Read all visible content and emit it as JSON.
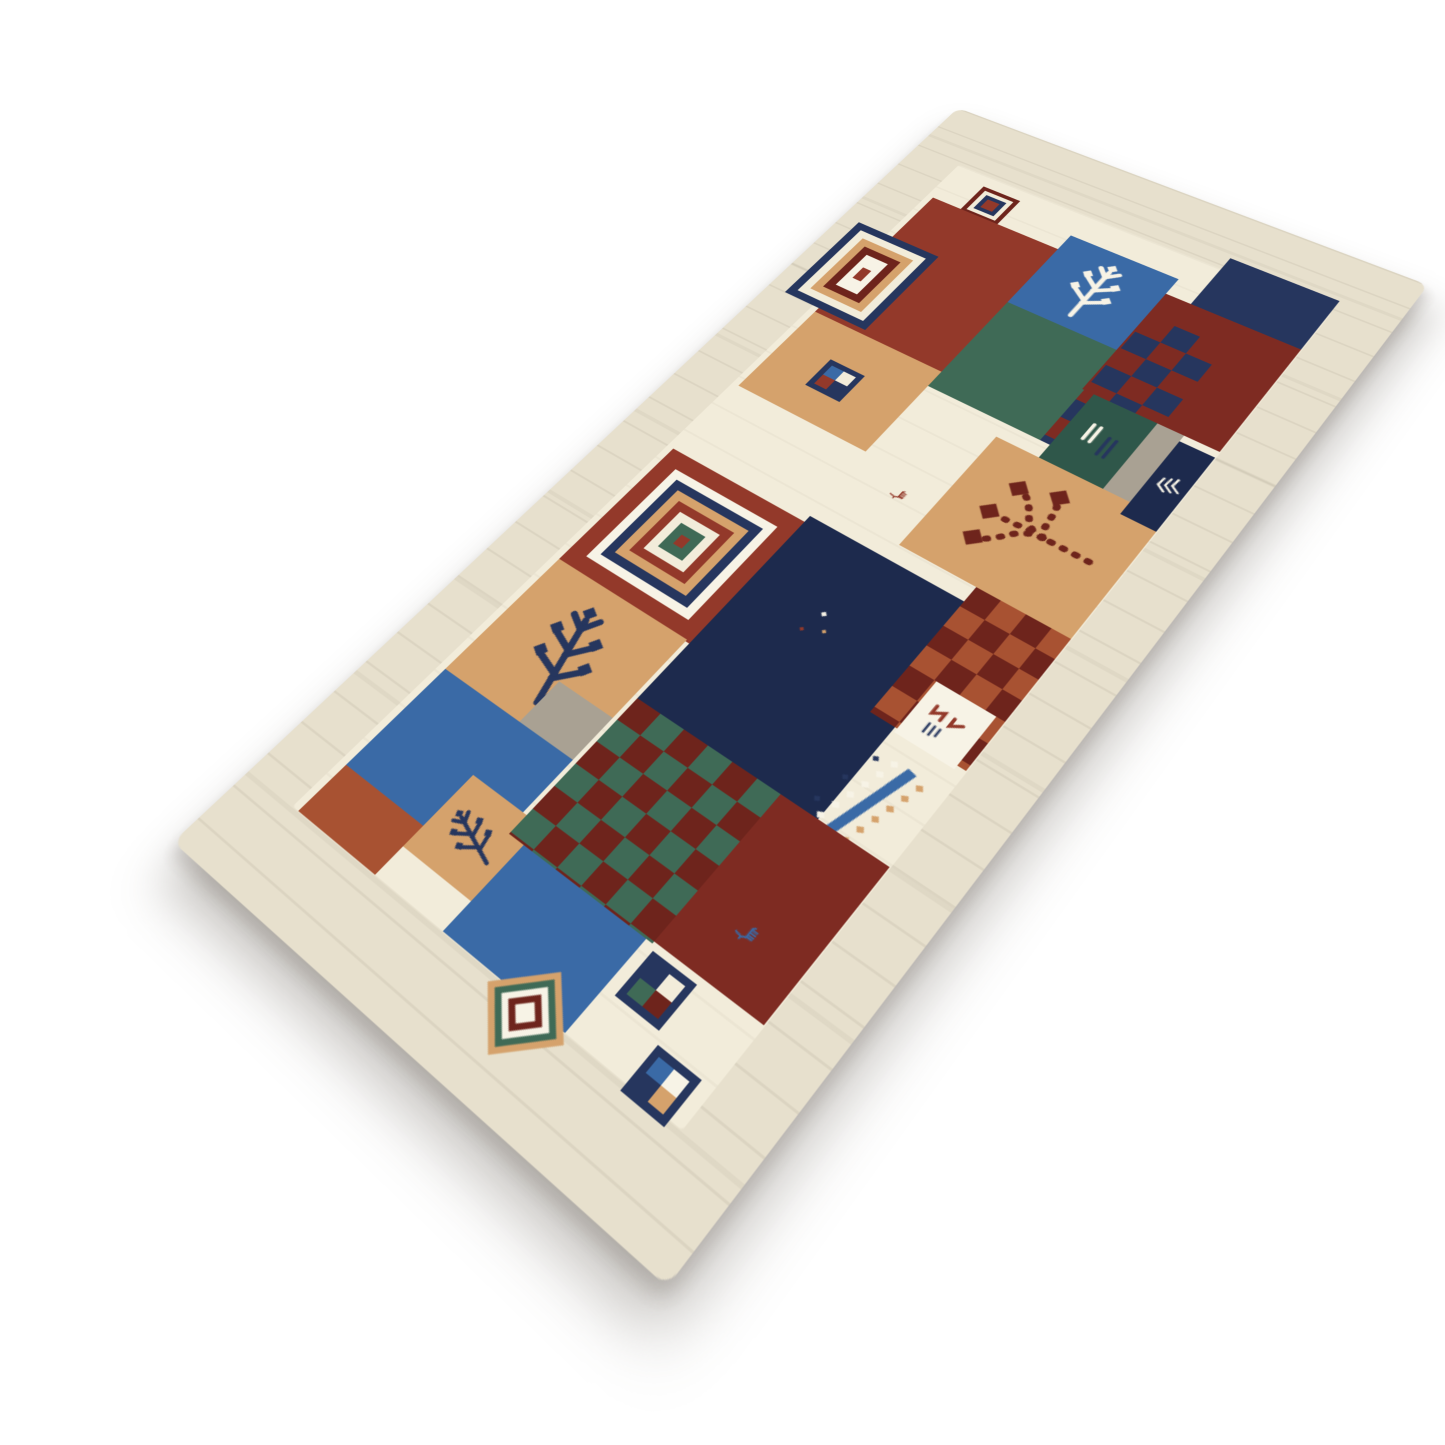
{
  "image": {
    "description": "Hand-knotted wool Gabbeh runner rug with a cream streaked border and a multicolour patchwork field of rust, navy, teal and camel blocks with tribal motifs, photographed at a diagonal angle on a plain white background",
    "background": "#ffffff"
  },
  "rug": {
    "type": "gabbeh-runner-rug",
    "flat_width": 1100,
    "flat_height": 520,
    "palette": {
      "cream_border": "#e7e0cd",
      "cream_field": "#f2ecda",
      "white": "#f7f3e6",
      "rust": "#93392a",
      "brick": "#a85232",
      "maroon": "#6e241c",
      "darkred": "#7e2b22",
      "navy": "#26365e",
      "navy_dark": "#1d2a4d",
      "blue": "#3a6aa6",
      "teal": "#3f6a56",
      "teal_dark": "#2f574a",
      "camel": "#d5a26c",
      "grey": "#a9a193"
    },
    "blocks": [
      {
        "name": "mini-square-motif",
        "x": 96,
        "y": 96,
        "w": 44,
        "h": 44,
        "motif": "rings",
        "rings": [
          "maroon",
          "cream_field",
          "navy",
          "rust"
        ]
      },
      {
        "name": "rust-block",
        "x": 138,
        "y": 62,
        "w": 202,
        "h": 148,
        "color": "rust"
      },
      {
        "name": "camel-block",
        "x": 340,
        "y": 62,
        "w": 120,
        "h": 148,
        "color": "camel"
      },
      {
        "name": "pinwheel-motif",
        "x": 384,
        "y": 114,
        "w": 40,
        "h": 40,
        "motif": "pinwheel",
        "colors": [
          "rust",
          "navy",
          "cream_field",
          "blue"
        ],
        "frame": "navy"
      },
      {
        "name": "square-medallion",
        "x": 210,
        "y": 20,
        "w": 124,
        "h": 98,
        "motif": "rings",
        "rings": [
          "navy",
          "cream_field",
          "camel",
          "maroon",
          "white"
        ],
        "dot": "rust"
      },
      {
        "name": "blue-twig-block",
        "x": 114,
        "y": 210,
        "w": 114,
        "h": 118,
        "color": "blue",
        "motif": "twig",
        "mcolor": "white",
        "mrot": -90
      },
      {
        "name": "teal-block",
        "x": 228,
        "y": 210,
        "w": 134,
        "h": 152,
        "color": "teal"
      },
      {
        "name": "darkred-block",
        "x": 138,
        "y": 328,
        "w": 150,
        "h": 136,
        "color": "darkred"
      },
      {
        "name": "checkerboard-navy",
        "x": 172,
        "y": 330,
        "w": 190,
        "h": 78,
        "motif": "checker",
        "c1": "navy",
        "c2": "darkred",
        "cell": 26
      },
      {
        "name": "teal-stripe-block",
        "x": 288,
        "y": 340,
        "w": 94,
        "h": 64,
        "color": "teal_dark",
        "motif": "stripes",
        "mcolor": "white"
      },
      {
        "name": "navy-block",
        "x": 62,
        "y": 354,
        "w": 76,
        "h": 110,
        "color": "navy"
      },
      {
        "name": "camel-berry-tree-block",
        "x": 380,
        "y": 296,
        "w": 150,
        "h": 168,
        "color": "camel",
        "motif": "berrytree",
        "mcolor": "maroon"
      },
      {
        "name": "grey-block",
        "x": 288,
        "y": 404,
        "w": 92,
        "h": 26,
        "color": "grey"
      },
      {
        "name": "chevron-block",
        "x": 296,
        "y": 430,
        "w": 100,
        "h": 34,
        "color": "navy_dark",
        "motif": "chevrons",
        "mcolor": "white",
        "mrot": 25
      },
      {
        "name": "rust-block-2",
        "x": 556,
        "y": 62,
        "w": 158,
        "h": 152,
        "color": "rust"
      },
      {
        "name": "big-square-medallion",
        "x": 574,
        "y": 80,
        "w": 122,
        "h": 118,
        "motif": "rings",
        "rings": [
          "white",
          "navy",
          "camel",
          "rust",
          "cream_field",
          "teal"
        ],
        "dot": "rust"
      },
      {
        "name": "navy-field-block",
        "x": 548,
        "y": 214,
        "w": 234,
        "h": 184,
        "color": "navy_dark"
      },
      {
        "name": "specks-motif",
        "x": 600,
        "y": 258,
        "w": 74,
        "h": 64,
        "motif": "specks"
      },
      {
        "name": "goat-motif",
        "x": 470,
        "y": 252,
        "w": 28,
        "h": 24,
        "motif": "goat",
        "mcolor": "rust"
      },
      {
        "name": "checkerboard-brick",
        "x": 530,
        "y": 374,
        "w": 150,
        "h": 90,
        "motif": "checker",
        "c1": "brick",
        "c2": "maroon",
        "cell": 24
      },
      {
        "name": "white-mark-block",
        "x": 626,
        "y": 400,
        "w": 58,
        "h": 56,
        "color": "white",
        "motif": "redmarks"
      },
      {
        "name": "diamond-chain-motif",
        "x": 690,
        "y": 372,
        "w": 128,
        "h": 92,
        "motif": "diamondchain"
      },
      {
        "name": "camel-twig-block",
        "x": 712,
        "y": 62,
        "w": 142,
        "h": 148,
        "color": "camel",
        "motif": "twig",
        "mcolor": "navy",
        "mrot": -75
      },
      {
        "name": "grey-block-2",
        "x": 806,
        "y": 150,
        "w": 48,
        "h": 60,
        "color": "grey"
      },
      {
        "name": "blue-block-2",
        "x": 854,
        "y": 62,
        "w": 114,
        "h": 148,
        "color": "blue"
      },
      {
        "name": "brick-block",
        "x": 968,
        "y": 62,
        "w": 52,
        "h": 92,
        "color": "brick"
      },
      {
        "name": "camel-tree-block-2",
        "x": 912,
        "y": 154,
        "w": 78,
        "h": 76,
        "color": "camel",
        "motif": "twig",
        "mcolor": "navy",
        "mrot": -20
      },
      {
        "name": "checkerboard-teal",
        "x": 780,
        "y": 214,
        "w": 152,
        "h": 148,
        "motif": "checker",
        "c1": "teal",
        "c2": "maroon",
        "cell": 25
      },
      {
        "name": "blue-block-3",
        "x": 932,
        "y": 230,
        "w": 88,
        "h": 126,
        "color": "blue"
      },
      {
        "name": "darkred-block-2",
        "x": 780,
        "y": 362,
        "w": 150,
        "h": 102,
        "color": "darkred"
      },
      {
        "name": "goat-motif-blue",
        "x": 866,
        "y": 398,
        "w": 36,
        "h": 28,
        "motif": "goat",
        "mcolor": "blue"
      },
      {
        "name": "pinwheel-motif-2",
        "x": 936,
        "y": 366,
        "w": 42,
        "h": 42,
        "motif": "pinwheel",
        "colors": [
          "teal",
          "maroon",
          "cream_field",
          "navy"
        ],
        "frame": "navy"
      },
      {
        "name": "pinwheel-motif-3",
        "x": 986,
        "y": 414,
        "w": 40,
        "h": 40,
        "motif": "pinwheel",
        "colors": [
          "navy",
          "camel",
          "white",
          "blue"
        ],
        "frame": "navy"
      },
      {
        "name": "diamond-medallion",
        "x": 1000,
        "y": 296,
        "w": 54,
        "h": 54,
        "motif": "rings",
        "rings": [
          "camel",
          "teal",
          "white",
          "maroon",
          "white"
        ],
        "rot": 45
      }
    ]
  }
}
